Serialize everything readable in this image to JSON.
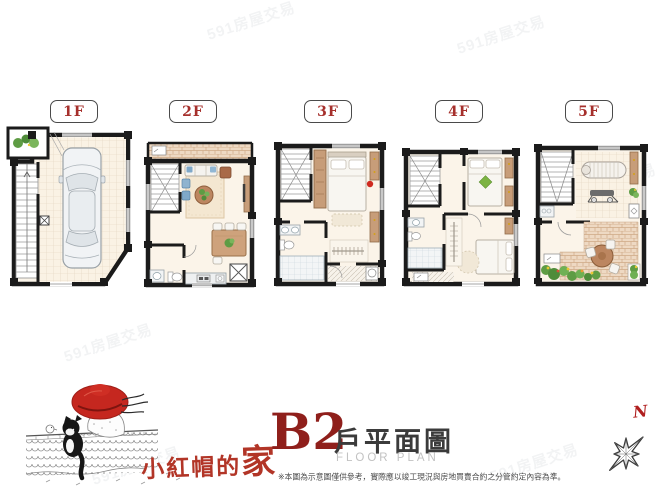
{
  "watermark": {
    "text": "591房屋交易"
  },
  "floors": [
    {
      "label": "1F"
    },
    {
      "label": "2F"
    },
    {
      "label": "3F"
    },
    {
      "label": "4F"
    },
    {
      "label": "5F"
    }
  ],
  "footer": {
    "brand": {
      "script_prefix": "小紅帽的",
      "script_home": "家"
    },
    "unit_code": "B2",
    "plan_title_zh": "戶平面圖",
    "plan_title_en": "FLOOR PLAN",
    "disclaimer": "※本圖為示意圖僅供參考，實際應以竣工現況與房地買賣合約之分管約定內容為準。"
  },
  "compass": {
    "north_label": "N"
  },
  "colors": {
    "floor_label_red": "#a6302c",
    "unit_code_red": "#8f1f1b",
    "brand_script_red": "#b23527",
    "title_dark_gray": "#3b3b3b",
    "title_light_gray": "#c2c2c2",
    "wall_black": "#1b1b1b",
    "floor_beige": "#fbf4e9",
    "wood_brown": "#c79d79",
    "plant_green": "#5e9c44",
    "hat_red": "#c5271f"
  }
}
